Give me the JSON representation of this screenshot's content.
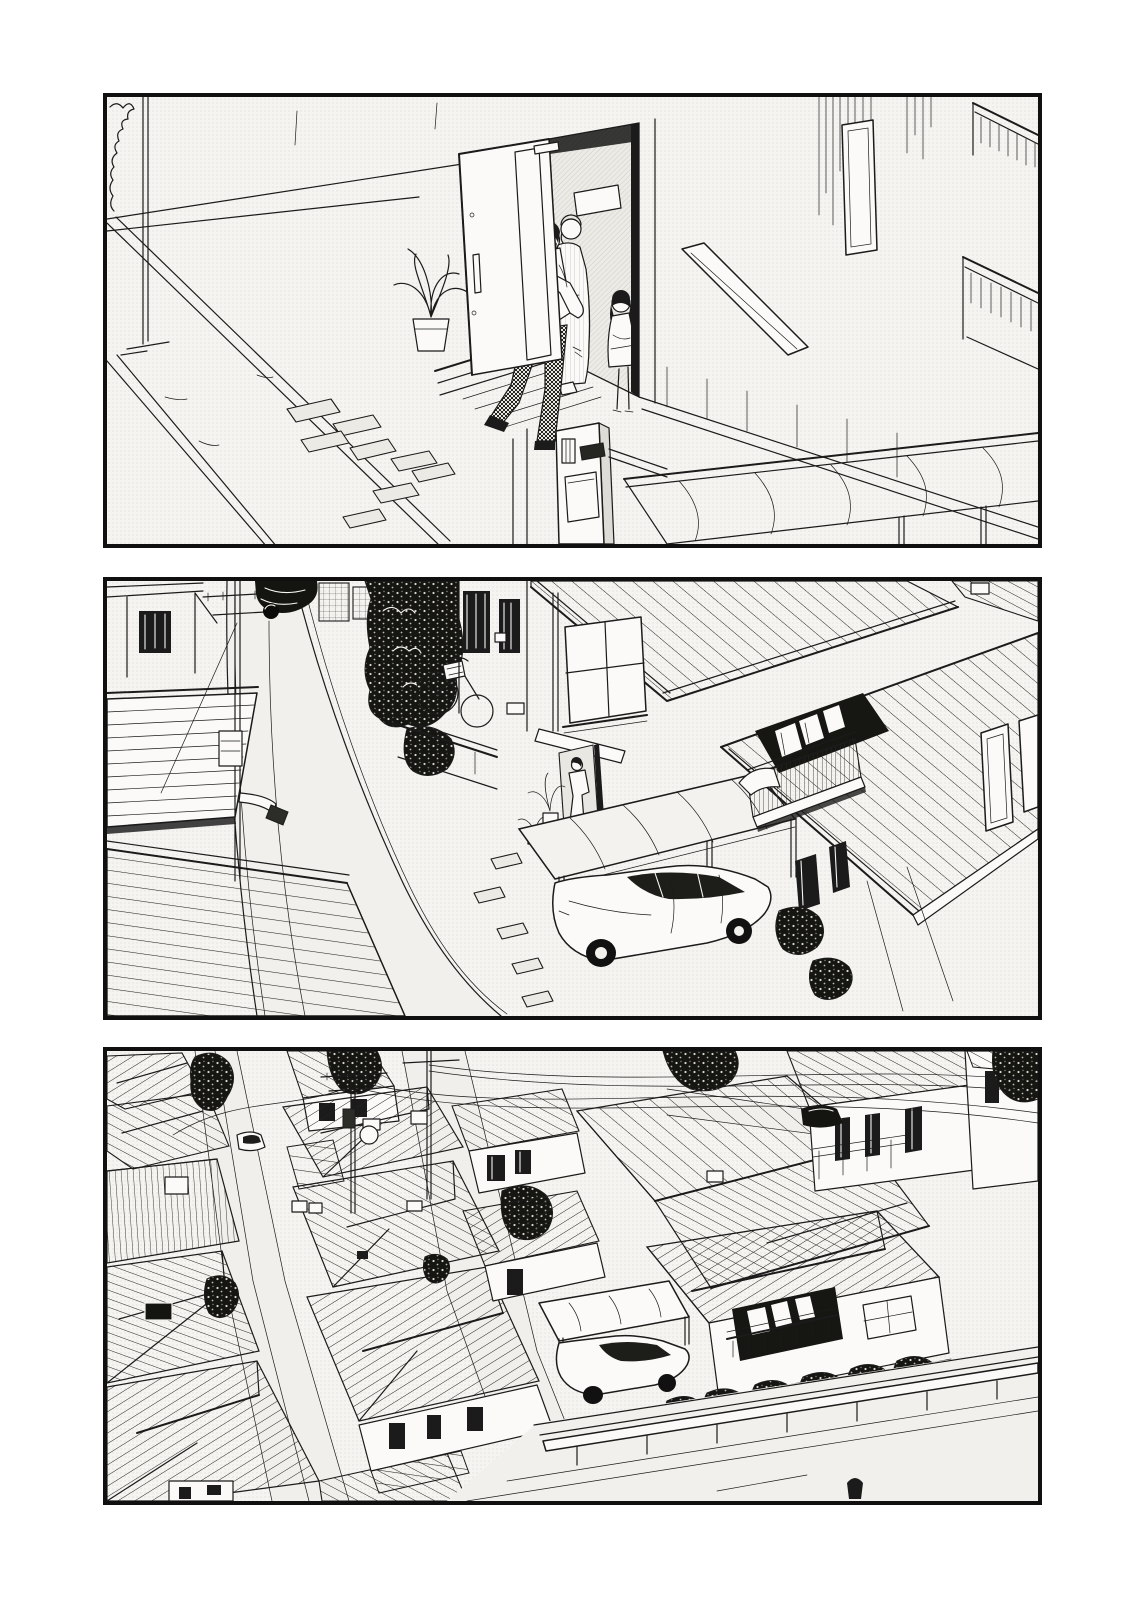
{
  "page": {
    "kind": "monochrome manga page, three stacked borderless-gutter panels, no dialogue text",
    "panel_count": 3,
    "colors": {
      "ink": "#1b1b1b",
      "paper": "#f5f4f1",
      "panel_border": "#101010",
      "page_background": "#ffffff"
    }
  },
  "panels": [
    {
      "name": "panel-1",
      "alt": "House entrance seen from above: a man in a white shirt and checkered trousers steps out of the open front door; a woman and a small girl stand in the doorway seeing him off; potted palm, stepping stones, mailbox pillar and corrugated awning."
    },
    {
      "name": "panel-2",
      "alt": "Bird's-eye view of the same house and its narrow street: utility pole, parked dark car, hedge and bicycle, two-story house with ribbed roofs, carport with white sedan, neighboring balcony with drying laundry."
    },
    {
      "name": "panel-3",
      "alt": "Wide aerial view of the dense residential neighborhood: rows of ribbed rooftops, lanes, utility poles and power lines, dark trees, gardens with potted plants, parked cars and a guardrail street in front."
    }
  ]
}
